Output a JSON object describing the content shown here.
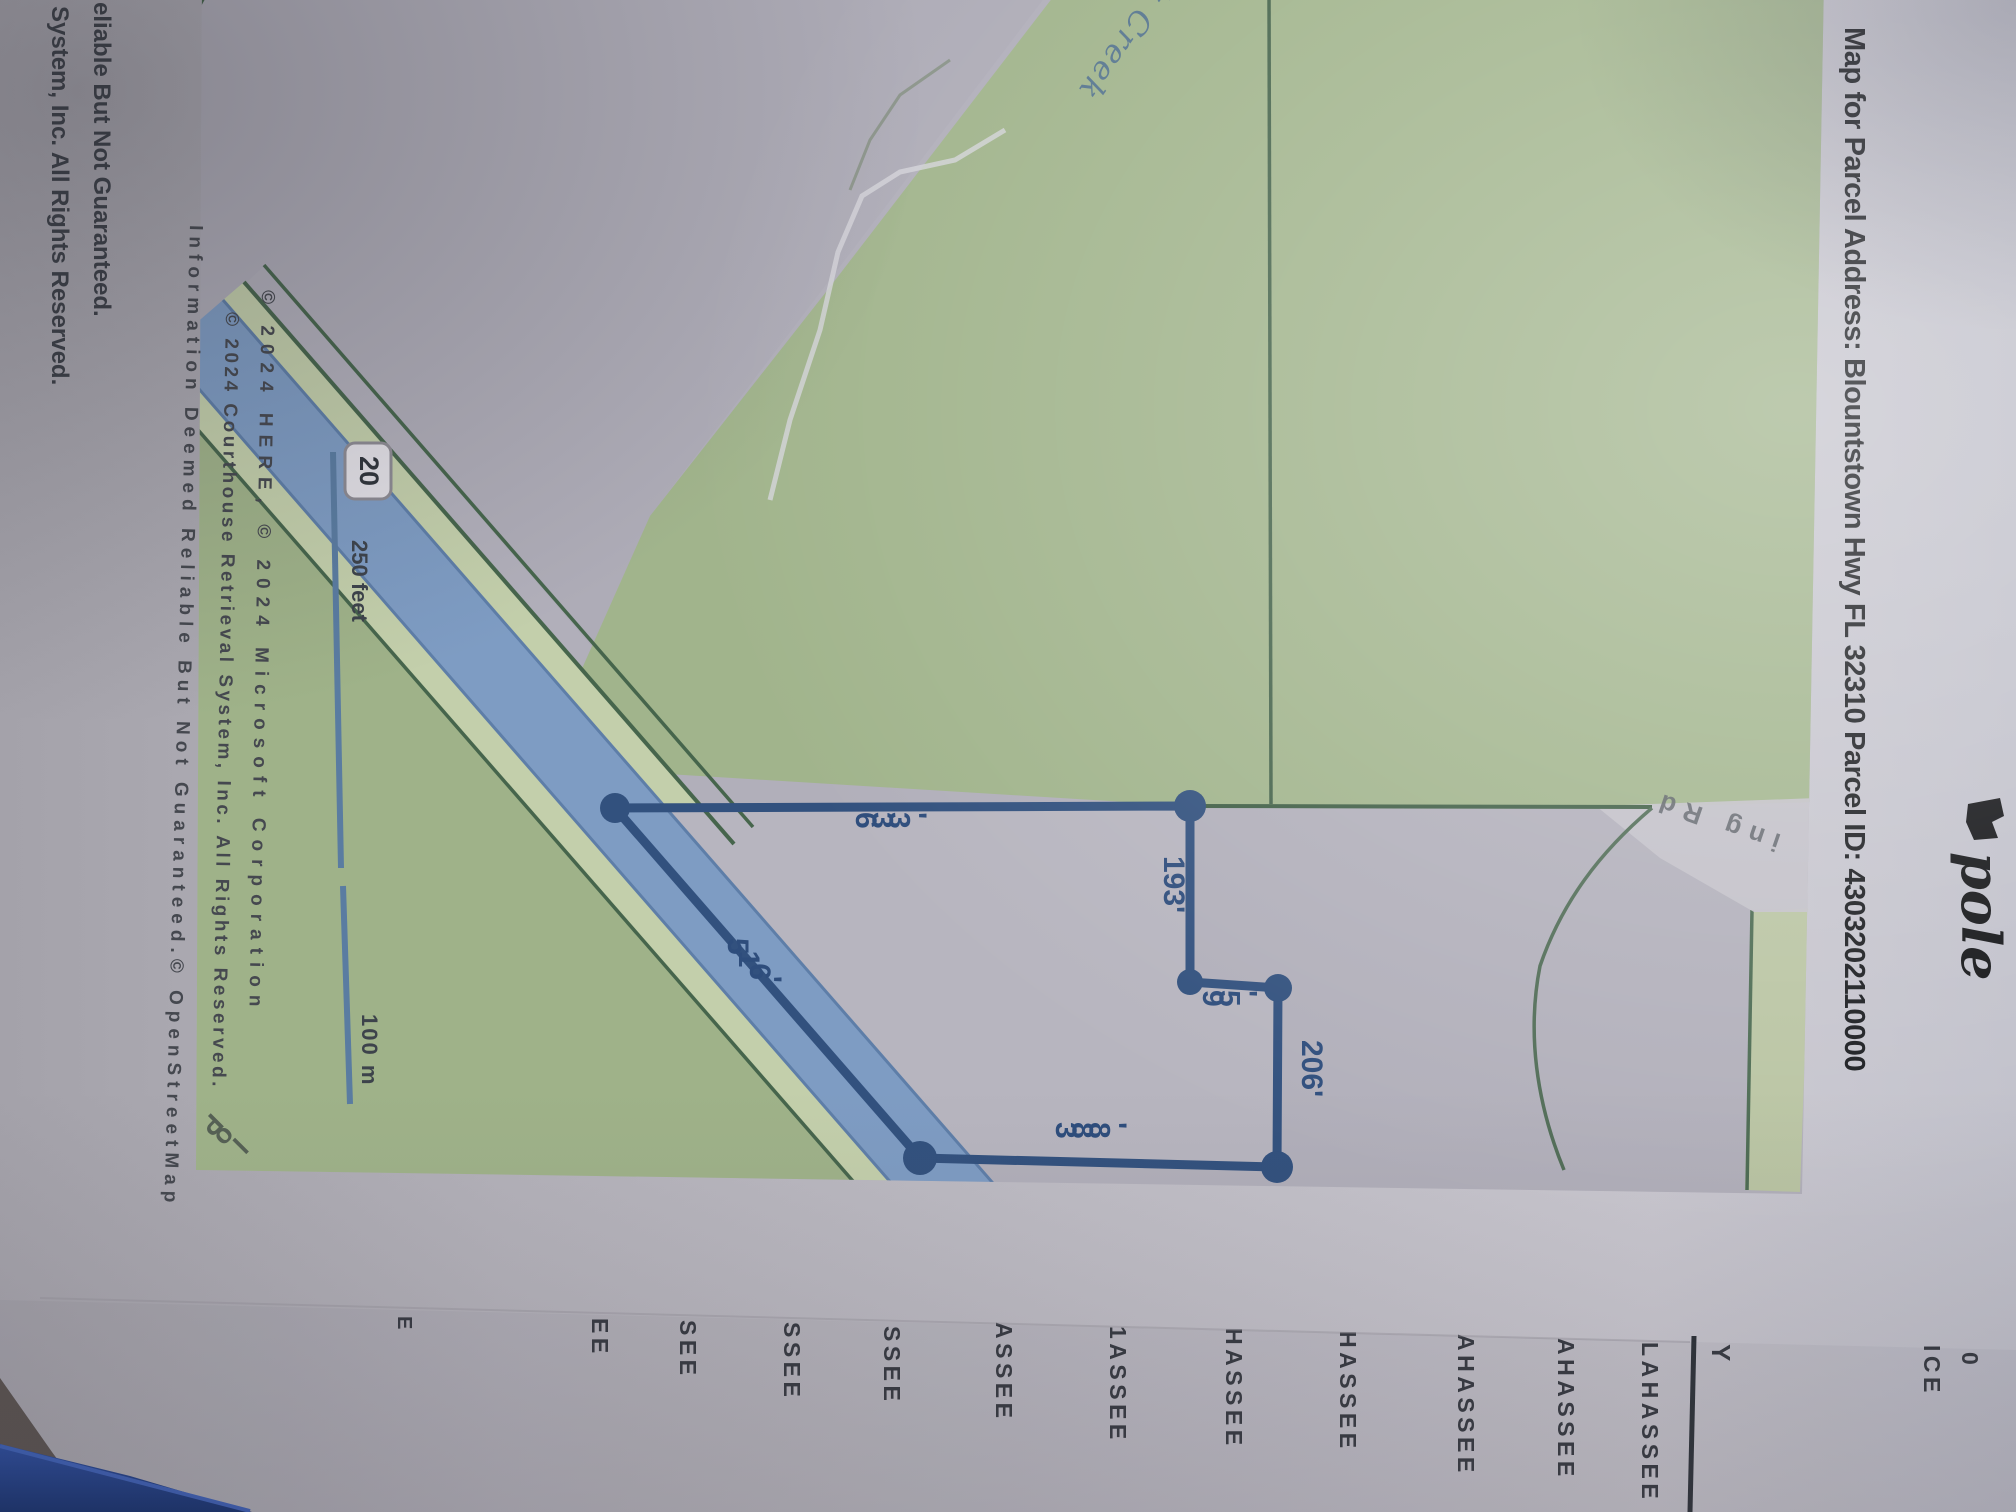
{
  "title": "Map for Parcel Address: Blountstown Hwy FL 32310 Parcel ID: 4303202110000",
  "handwritten_note": "pole",
  "header_fragments": {
    "ice": "ICE",
    "zero": "0"
  },
  "map": {
    "creek_label": "lk Creek",
    "road_label": "ing Rd",
    "corner_road_label": "Pol",
    "highway_shield": "20",
    "scale_feet": "250 feet",
    "scale_meters": "100 m",
    "dimensions": {
      "north": "633'",
      "jog_west": "193'",
      "jog_north": "95'",
      "east": "206'",
      "south": "388'",
      "frontage": "516'"
    },
    "attribution": [
      "© 2024 HERE, © 2024 Microsoft Corporation",
      "© 2024 Courthouse Retrieval System, Inc. All Rights Reserved.",
      "Information Deemed Reliable But Not Guaranteed.© OpenStreetMap"
    ]
  },
  "footer_lines": [
    "System, Inc. All Rights Reserved.",
    "eliable But Not Guaranteed."
  ],
  "edge_fragments": [
    "E",
    "EE",
    "SEE",
    "SSEE",
    "SSEE",
    "ASSEE",
    "1ASSEE",
    "HASSEE",
    "HASSEE",
    "AHASSEE",
    "AHASSEE",
    "LAHASSEE",
    "Y"
  ],
  "colors": {
    "parcel_line": "#32517e",
    "road_fill": "#7e9cc3",
    "map_green": "#a1b48c",
    "paper": "#bfbdc5",
    "blue_object": "#1d3a86"
  }
}
